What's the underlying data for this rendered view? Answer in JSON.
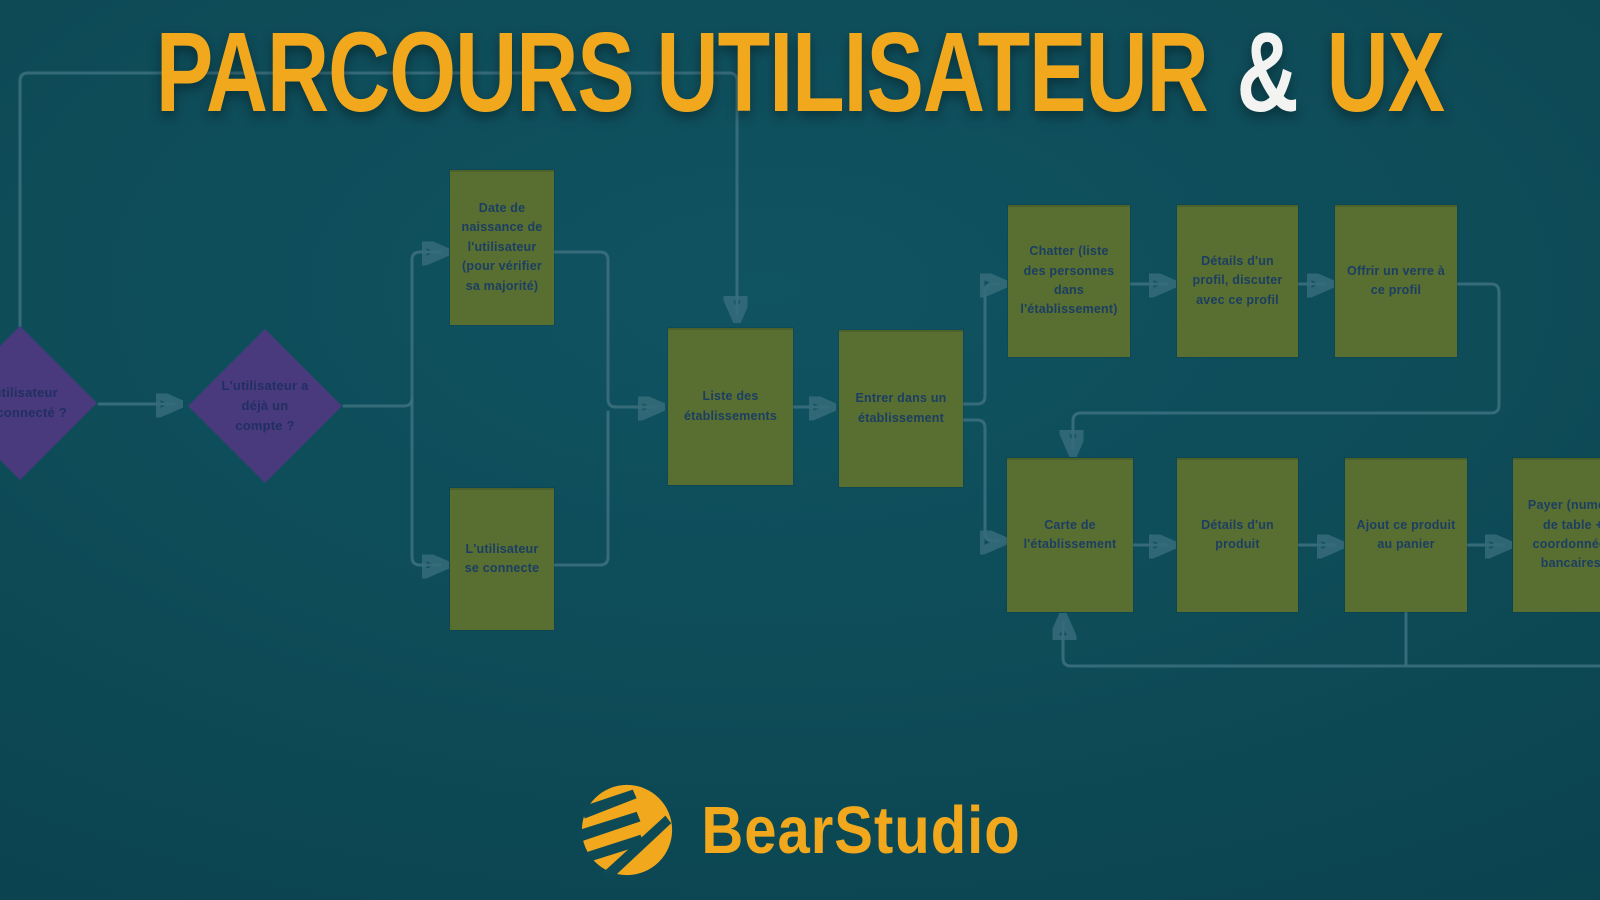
{
  "title": {
    "part1": "PARCOURS UTILISATEUR",
    "amp": "&",
    "part2": "UX"
  },
  "nodes": {
    "d1": {
      "label": "L'utilisateur est connecté ?",
      "type": "decision"
    },
    "d2": {
      "label": "L'utilisateur a déjà un compte ?",
      "type": "decision"
    },
    "birthdate": {
      "label": "Date de naissance de l'utilisateur (pour vérifier sa majorité)",
      "type": "step"
    },
    "login": {
      "label": "L'utilisateur se connecte",
      "type": "step"
    },
    "list": {
      "label": "Liste des établissements",
      "type": "step"
    },
    "enter": {
      "label": "Entrer dans un établissement",
      "type": "step"
    },
    "chat": {
      "label": "Chatter (liste des personnes dans l'établissement)",
      "type": "step"
    },
    "profile": {
      "label": "Détails d'un profil, discuter avec ce profil",
      "type": "step"
    },
    "drink": {
      "label": "Offrir un verre à ce profil",
      "type": "step"
    },
    "menu": {
      "label": "Carte de l'établissement",
      "type": "step"
    },
    "product": {
      "label": "Détails d'un produit",
      "type": "step"
    },
    "cart": {
      "label": "Ajout ce produit au panier",
      "type": "step"
    },
    "pay": {
      "label": "Payer (numéro de table + coordonnées bancaires)",
      "type": "step"
    }
  },
  "footer": {
    "brand": "BearStudio"
  },
  "colors": {
    "background": "#0d4a56",
    "title_yellow": "#f1a81d",
    "ampersand_white": "#f3f4f1",
    "step_green": "#586f31",
    "decision_purple": "#483a7c",
    "node_text_navy": "#1c3e62",
    "connector_teal": "#3d7180"
  }
}
